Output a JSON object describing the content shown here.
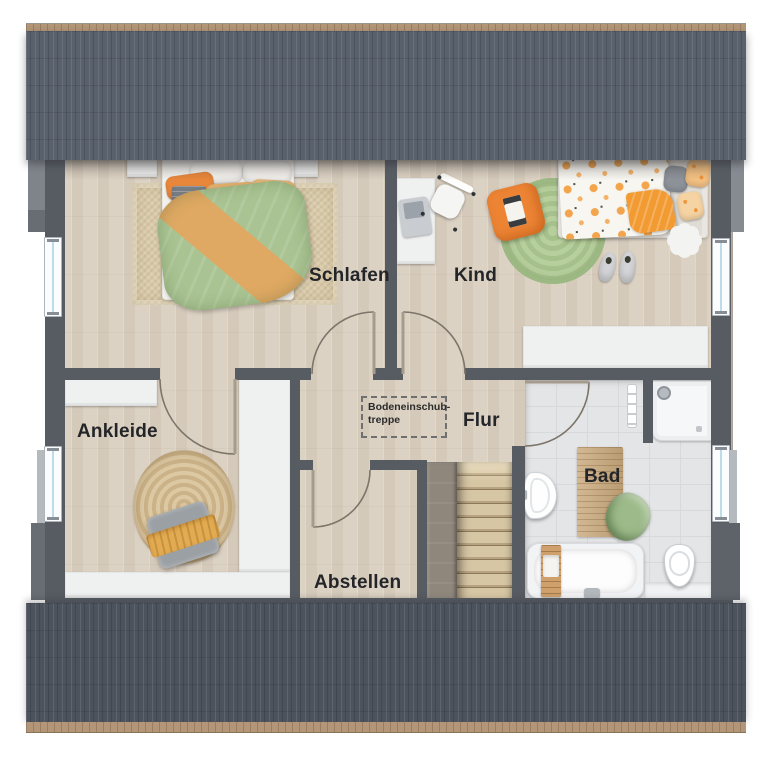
{
  "rooms": {
    "schlafen": "Schlafen",
    "kind": "Kind",
    "ankleide": "Ankleide",
    "flur": "Flur",
    "abstellen": "Abstellen",
    "bad": "Bad"
  },
  "annotations": {
    "attic_hatch": {
      "line1": "Bodeneinschub-",
      "line2": "treppe"
    }
  },
  "colors": {
    "wall": "#575c63",
    "roof_top": "#59616d",
    "roof_bottom": "#4c535d",
    "roof_ridge_tan": "#b29677",
    "floor_wood": "#dcd2c4",
    "bath_tile": "#e4e5e7",
    "accent_orange": "#ed8434",
    "accent_green": "#a9c492",
    "cabinet_white": "#eff0f0"
  },
  "furniture": {
    "schlafen": [
      "double-bed-icon",
      "nightstand-icon",
      "nightstand-icon",
      "area-rug-icon"
    ],
    "kind": [
      "single-bed-icon",
      "desk-icon",
      "laptop-icon",
      "desk-chair-icon",
      "floor-cushion-icon",
      "round-rug-icon",
      "flower-side-table-icon",
      "slippers-icon",
      "sideboard-icon"
    ],
    "ankleide": [
      "wardrobe-icon",
      "wardrobe-icon",
      "wardrobe-icon",
      "jute-rug-icon",
      "bench-icon",
      "towel-icon"
    ],
    "flur": [
      "staircase-icon",
      "attic-hatch-icon"
    ],
    "bad": [
      "bathtub-icon",
      "bath-caddy-icon",
      "washbasin-icon",
      "shower-icon",
      "toilet-icon",
      "towel-radiator-icon",
      "bath-mat-icon",
      "towel-icon"
    ],
    "window_count": 4,
    "door_count": 5
  }
}
